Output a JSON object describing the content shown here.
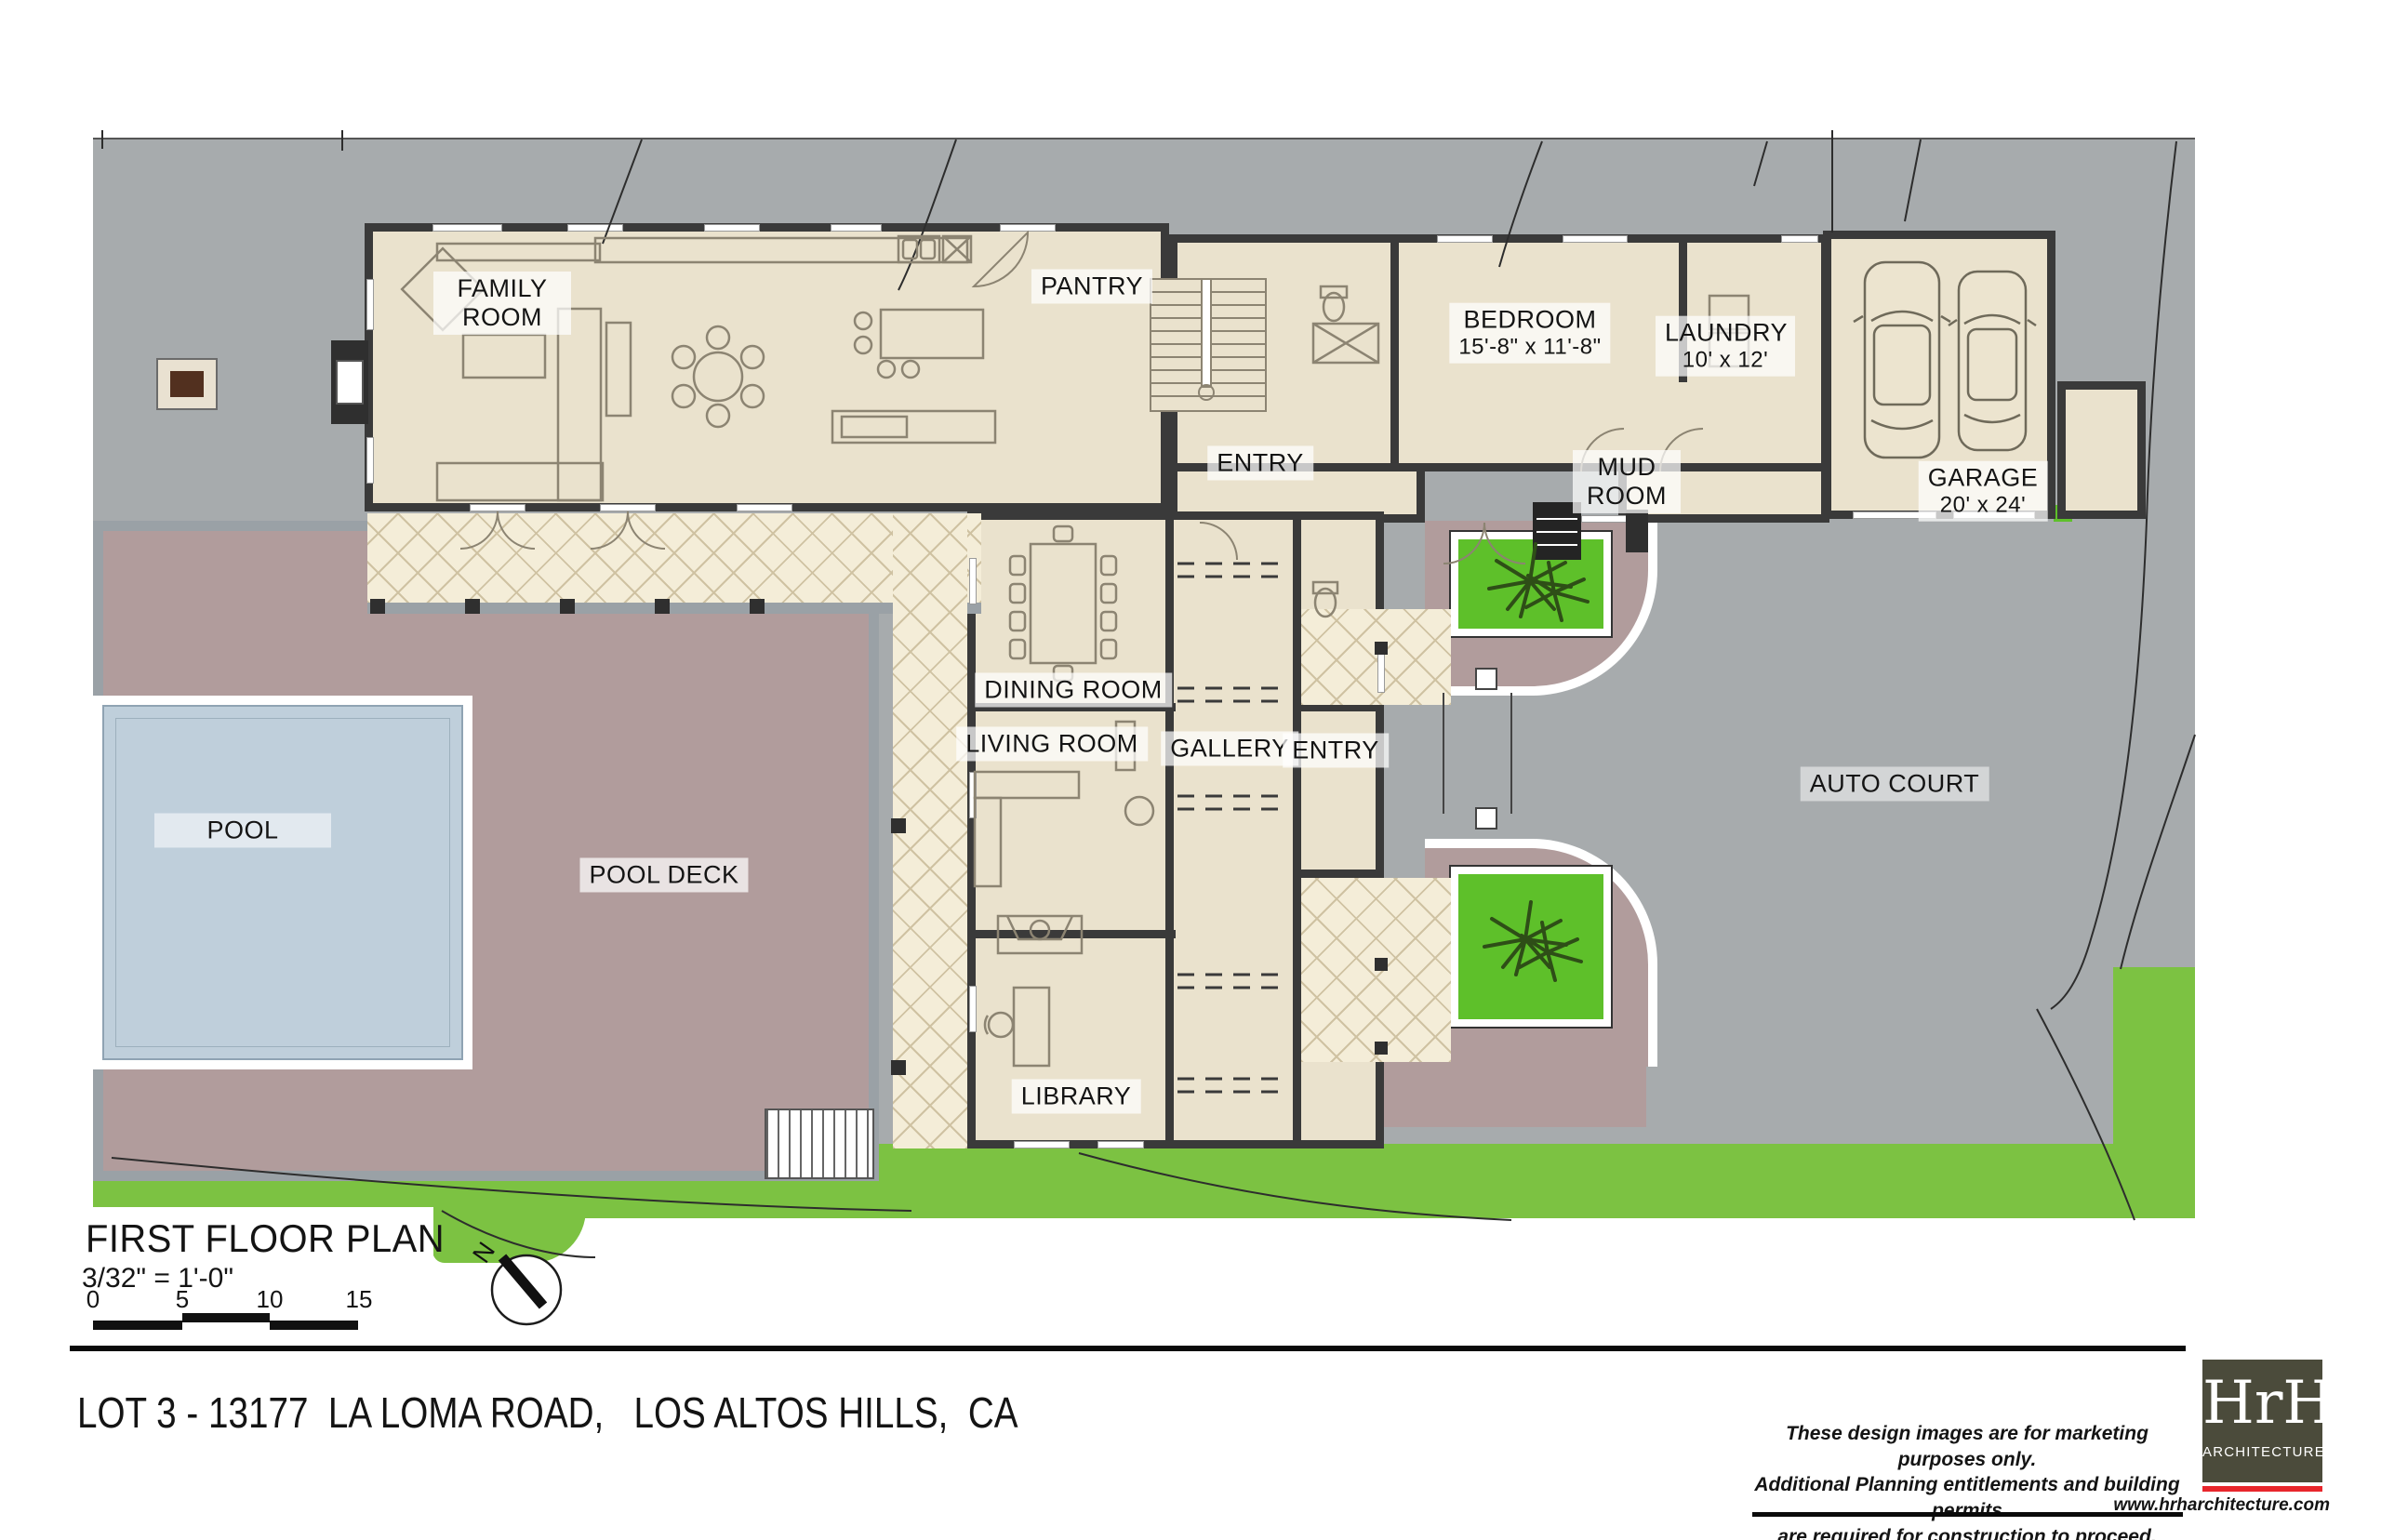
{
  "plan": {
    "rooms": {
      "family_room": {
        "label": "FAMILY ROOM"
      },
      "pantry": {
        "label": "PANTRY"
      },
      "bedroom": {
        "label": "BEDROOM",
        "dims": "15'-8\" x 11'-8\""
      },
      "laundry": {
        "label": "LAUNDRY",
        "dims": "10' x 12'"
      },
      "entry_hall": {
        "label": "ENTRY"
      },
      "mud_room": {
        "label": "MUD ROOM"
      },
      "garage": {
        "label": "GARAGE",
        "dims": "20' x 24'"
      },
      "dining_room": {
        "label": "DINING ROOM"
      },
      "living_room": {
        "label": "LIVING ROOM"
      },
      "gallery": {
        "label": "GALLERY"
      },
      "entry": {
        "label": "ENTRY"
      },
      "library": {
        "label": "LIBRARY"
      }
    },
    "site_labels": {
      "pool": {
        "label": "POOL"
      },
      "pool_deck": {
        "label": "POOL DECK"
      },
      "auto_court": {
        "label": "AUTO COURT"
      }
    }
  },
  "title_block": {
    "title": "FIRST FLOOR PLAN",
    "scale": "3/32\" = 1'-0\"",
    "scale_bar_ticks": [
      "0",
      "5",
      "10",
      "15"
    ],
    "north_label": "N"
  },
  "footer": {
    "address": "LOT 3 - 13177  LA LOMA ROAD,   LOS ALTOS HILLS,  CA",
    "disclaimer_lines": [
      "These design images are for marketing purposes only.",
      "Additional Planning entitlements and building permits",
      "are required for construction to proceed."
    ],
    "logo": {
      "name": "HrH",
      "subtitle": "ARCHITECTURE",
      "website": "www.hrharchitecture.com"
    }
  },
  "colors": {
    "wall": "#3a3a3a",
    "house": "#eae2cd",
    "hatch": "#f4edd8",
    "hatchline": "#cfc2a2",
    "site": "#a7abad",
    "grass": "#7cc242",
    "planter": "#5ec02a",
    "deck": "#b19c9c",
    "coping": "#9aa1a6",
    "pool": "#bfcfdb",
    "logobg": "#4b4b3b",
    "logored": "#e8262c"
  }
}
